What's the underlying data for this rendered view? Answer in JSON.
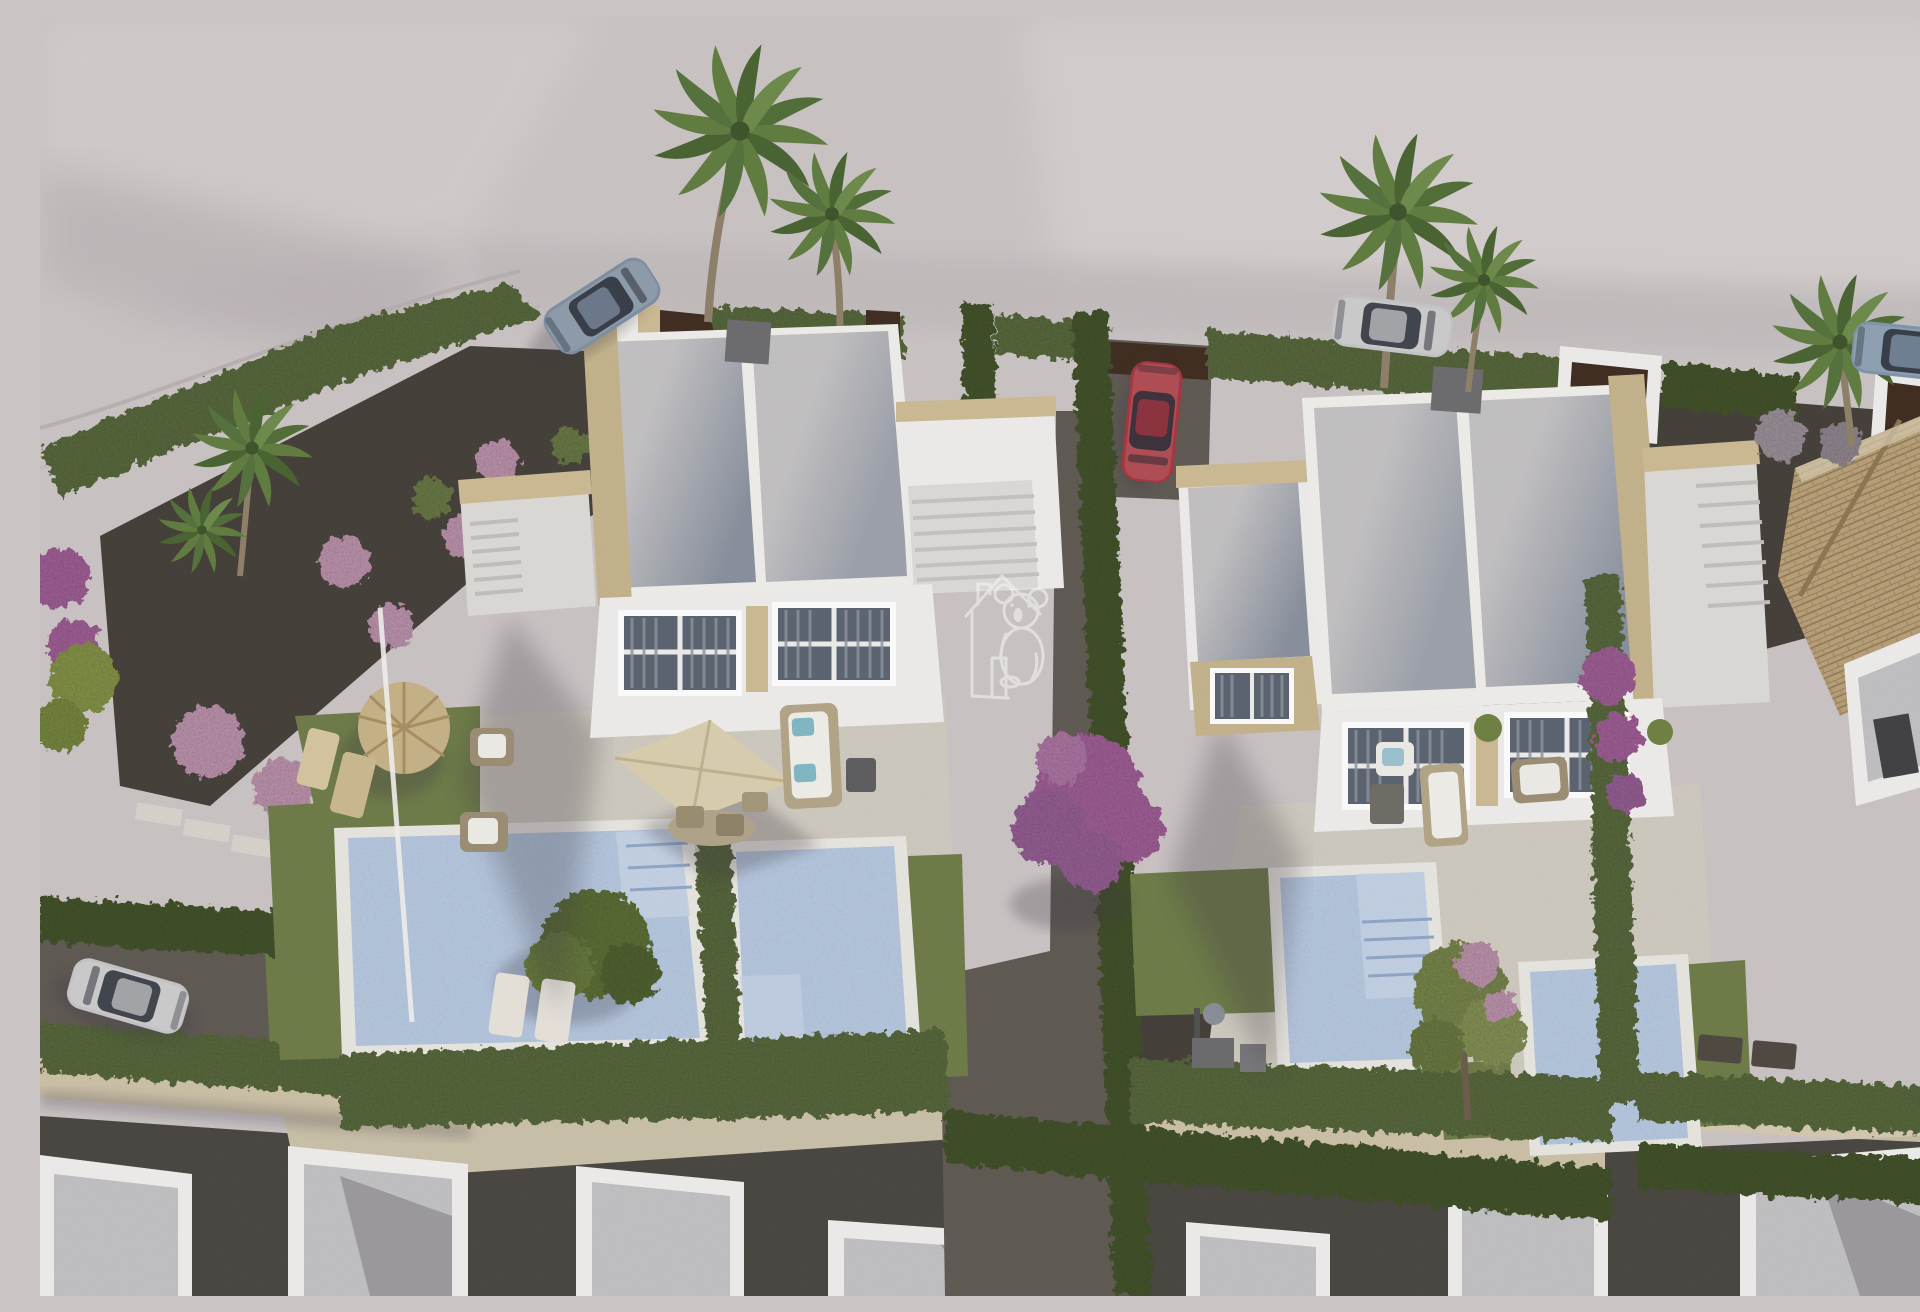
{
  "scene": {
    "type": "3d-architectural-aerial-render",
    "description": "Aerial 3D architectural rendering of a modern residential development: two semi-detached white flat-roofed villas with private swimming pools, beige terraces, landscaped gravel gardens with pink flowering shrubs, cypress hedges, palm trees, parked cars, a tiled-roof neighbouring house and a row of white buildings along the bottom road",
    "watermark": {
      "icon": "house-koala-logo",
      "color": "#ffffff",
      "opacity": 0.52
    },
    "objects": [
      "left-villa",
      "right-villa",
      "rooftop-terraces",
      "swimming-pools",
      "garden-parasol",
      "thatched-parasol",
      "sun-loungers",
      "outdoor-sofa",
      "cypress-hedges",
      "palm-trees",
      "bougainvillea-tree",
      "flowering-shrubs",
      "sports-car",
      "red-car",
      "estate-car",
      "suv-car",
      "hatchback-car",
      "tiled-roof-house",
      "bottom-row-buildings",
      "stone-walls",
      "stepping-stones"
    ]
  },
  "palette": {
    "ground": "#ccc5c6",
    "ground_light": "#d8d3d2",
    "road_band": "#c1babb",
    "asphalt": "#4a4643",
    "gravel_dark": "#453f38",
    "gravel_mid": "#605b55",
    "villa_wall": "#f1efec",
    "villa_wall_shade": "#dedcd9",
    "roof_light": "#c9c8ca",
    "roof_shadow": "#8d95a4",
    "stone_trim": "#cdbb92",
    "stone_wall": "#d5c9ae",
    "terrace": "#d8d3c8",
    "pool_water": "#a9bdd8",
    "pool_water_light": "#c6d3e6",
    "grass": "#71804a",
    "hedge": "#5a6a3c",
    "hedge_dark": "#42522c",
    "palm": "#5e7c3e",
    "parasol": "#dccfb0",
    "straw": "#c8b386",
    "tile_roof": "#b79f77",
    "gate_brown": "#3c2a1c",
    "car_red": "#a8323c",
    "car_silver": "#c6c6c8",
    "car_blue": "#7e8ea1",
    "car_suv_blue": "#8095ab",
    "flower_pink": "#c89ab8",
    "flower_purple": "#9d5e9b",
    "bougainvillea": "#a85f9f"
  }
}
